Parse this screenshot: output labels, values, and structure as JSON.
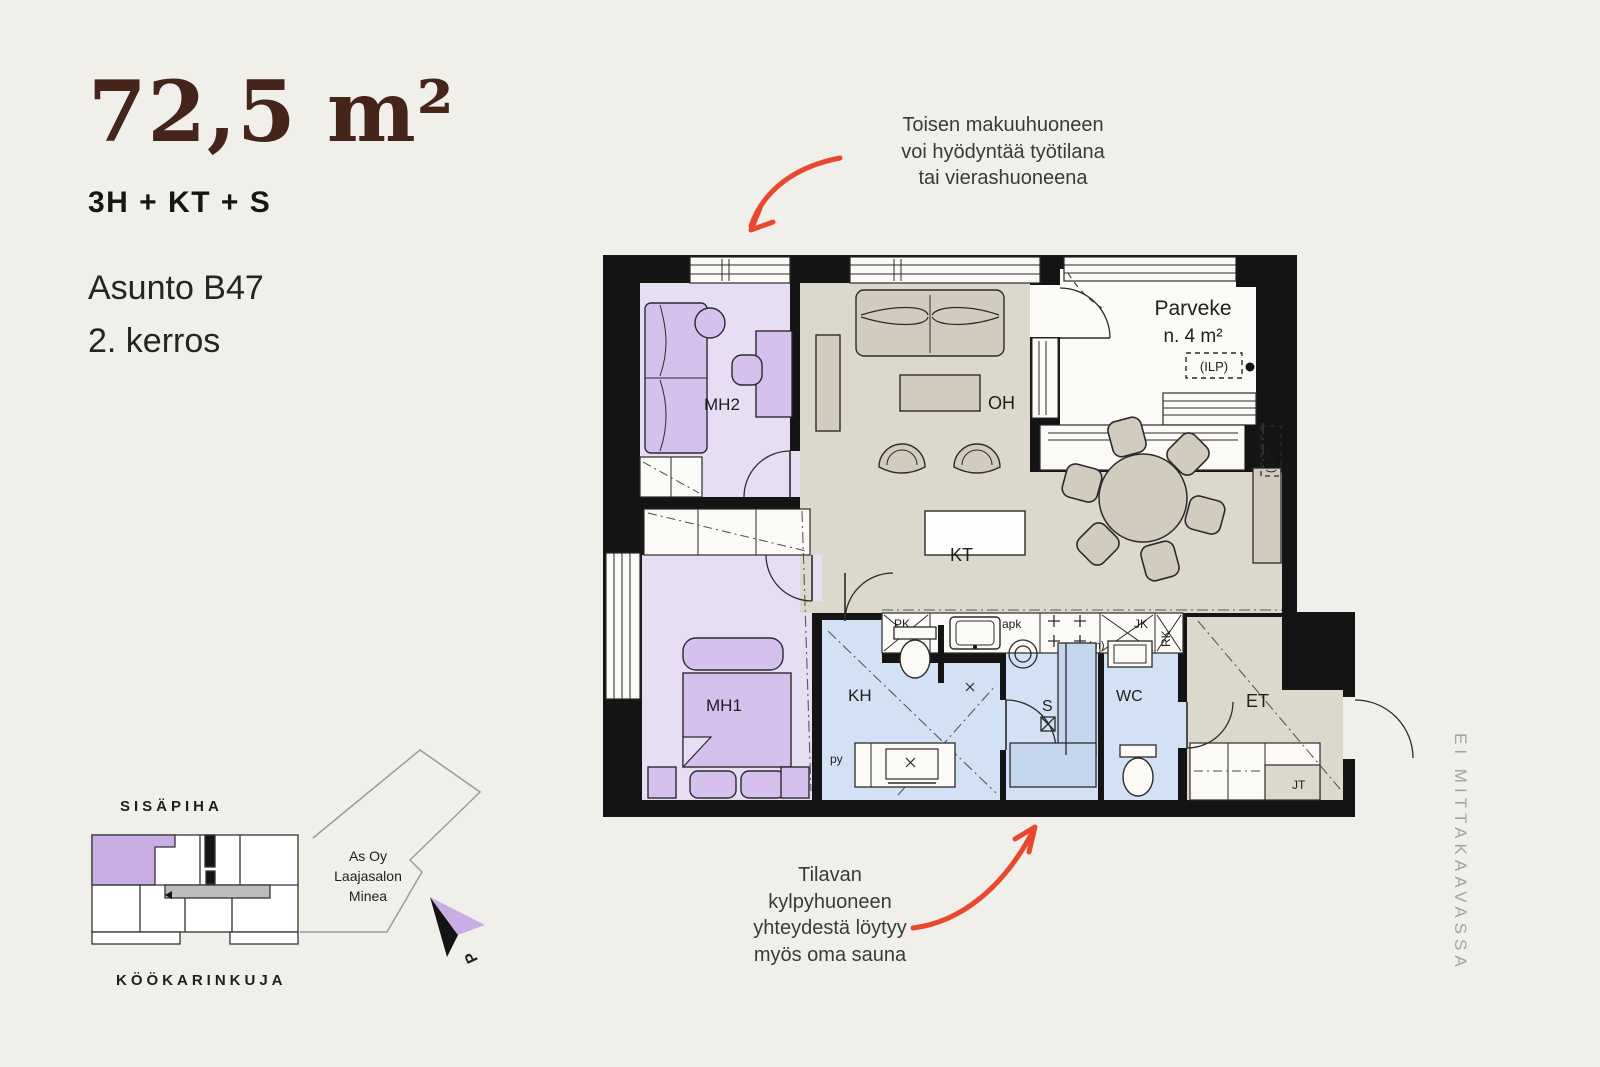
{
  "page": {
    "background": "#f0efe9"
  },
  "header": {
    "area": "72,5 m²",
    "layout": "3H + KT + S",
    "apartment": "Asunto B47",
    "floor": "2. kerros",
    "accent_color": "#45241a"
  },
  "annotation_top": {
    "lines": [
      "Toisen makuuhuoneen",
      "voi hyödyntää työtilana",
      "tai vierashuoneena"
    ]
  },
  "annotation_bottom": {
    "lines": [
      "Tilavan",
      "kylpyhuoneen",
      "yhteydestä löytyy",
      "myös oma sauna"
    ]
  },
  "arrow_color": "#e8492e",
  "floorplan": {
    "rooms": {
      "mh2": "MH2",
      "oh": "OH",
      "kt": "KT",
      "mh1": "MH1",
      "kh": "KH",
      "sauna": "S",
      "wc": "WC",
      "et": "ET"
    },
    "balcony": {
      "name": "Parveke",
      "area": "n. 4 m²",
      "ilp": "(ILP)"
    },
    "labels": {
      "pk": "PK",
      "apk": "apk",
      "m": "(m)",
      "jk": "JK",
      "rk": "RK",
      "jt": "JT",
      "py": "py",
      "ilp_wall": "(ILP)"
    },
    "colors": {
      "wall": "#141414",
      "bedroom": "#e8def4",
      "bedroom_furniture": "#d6c0ee",
      "living": "#dcd8cc",
      "living_furniture": "#d1ccbd",
      "wet": "#d2e2f4",
      "paper": "#fbfaf6"
    }
  },
  "siteplan": {
    "street_top": "SISÄPIHA",
    "street_bottom": "KÖÖKARINKUJA",
    "company": [
      "As Oy",
      "Laajasalon",
      "Minea"
    ],
    "north_label": "P",
    "highlight_color": "#c9aee6",
    "muted_color": "#9c9c98"
  },
  "scale_note": "EI MITTAKAAVASSA"
}
